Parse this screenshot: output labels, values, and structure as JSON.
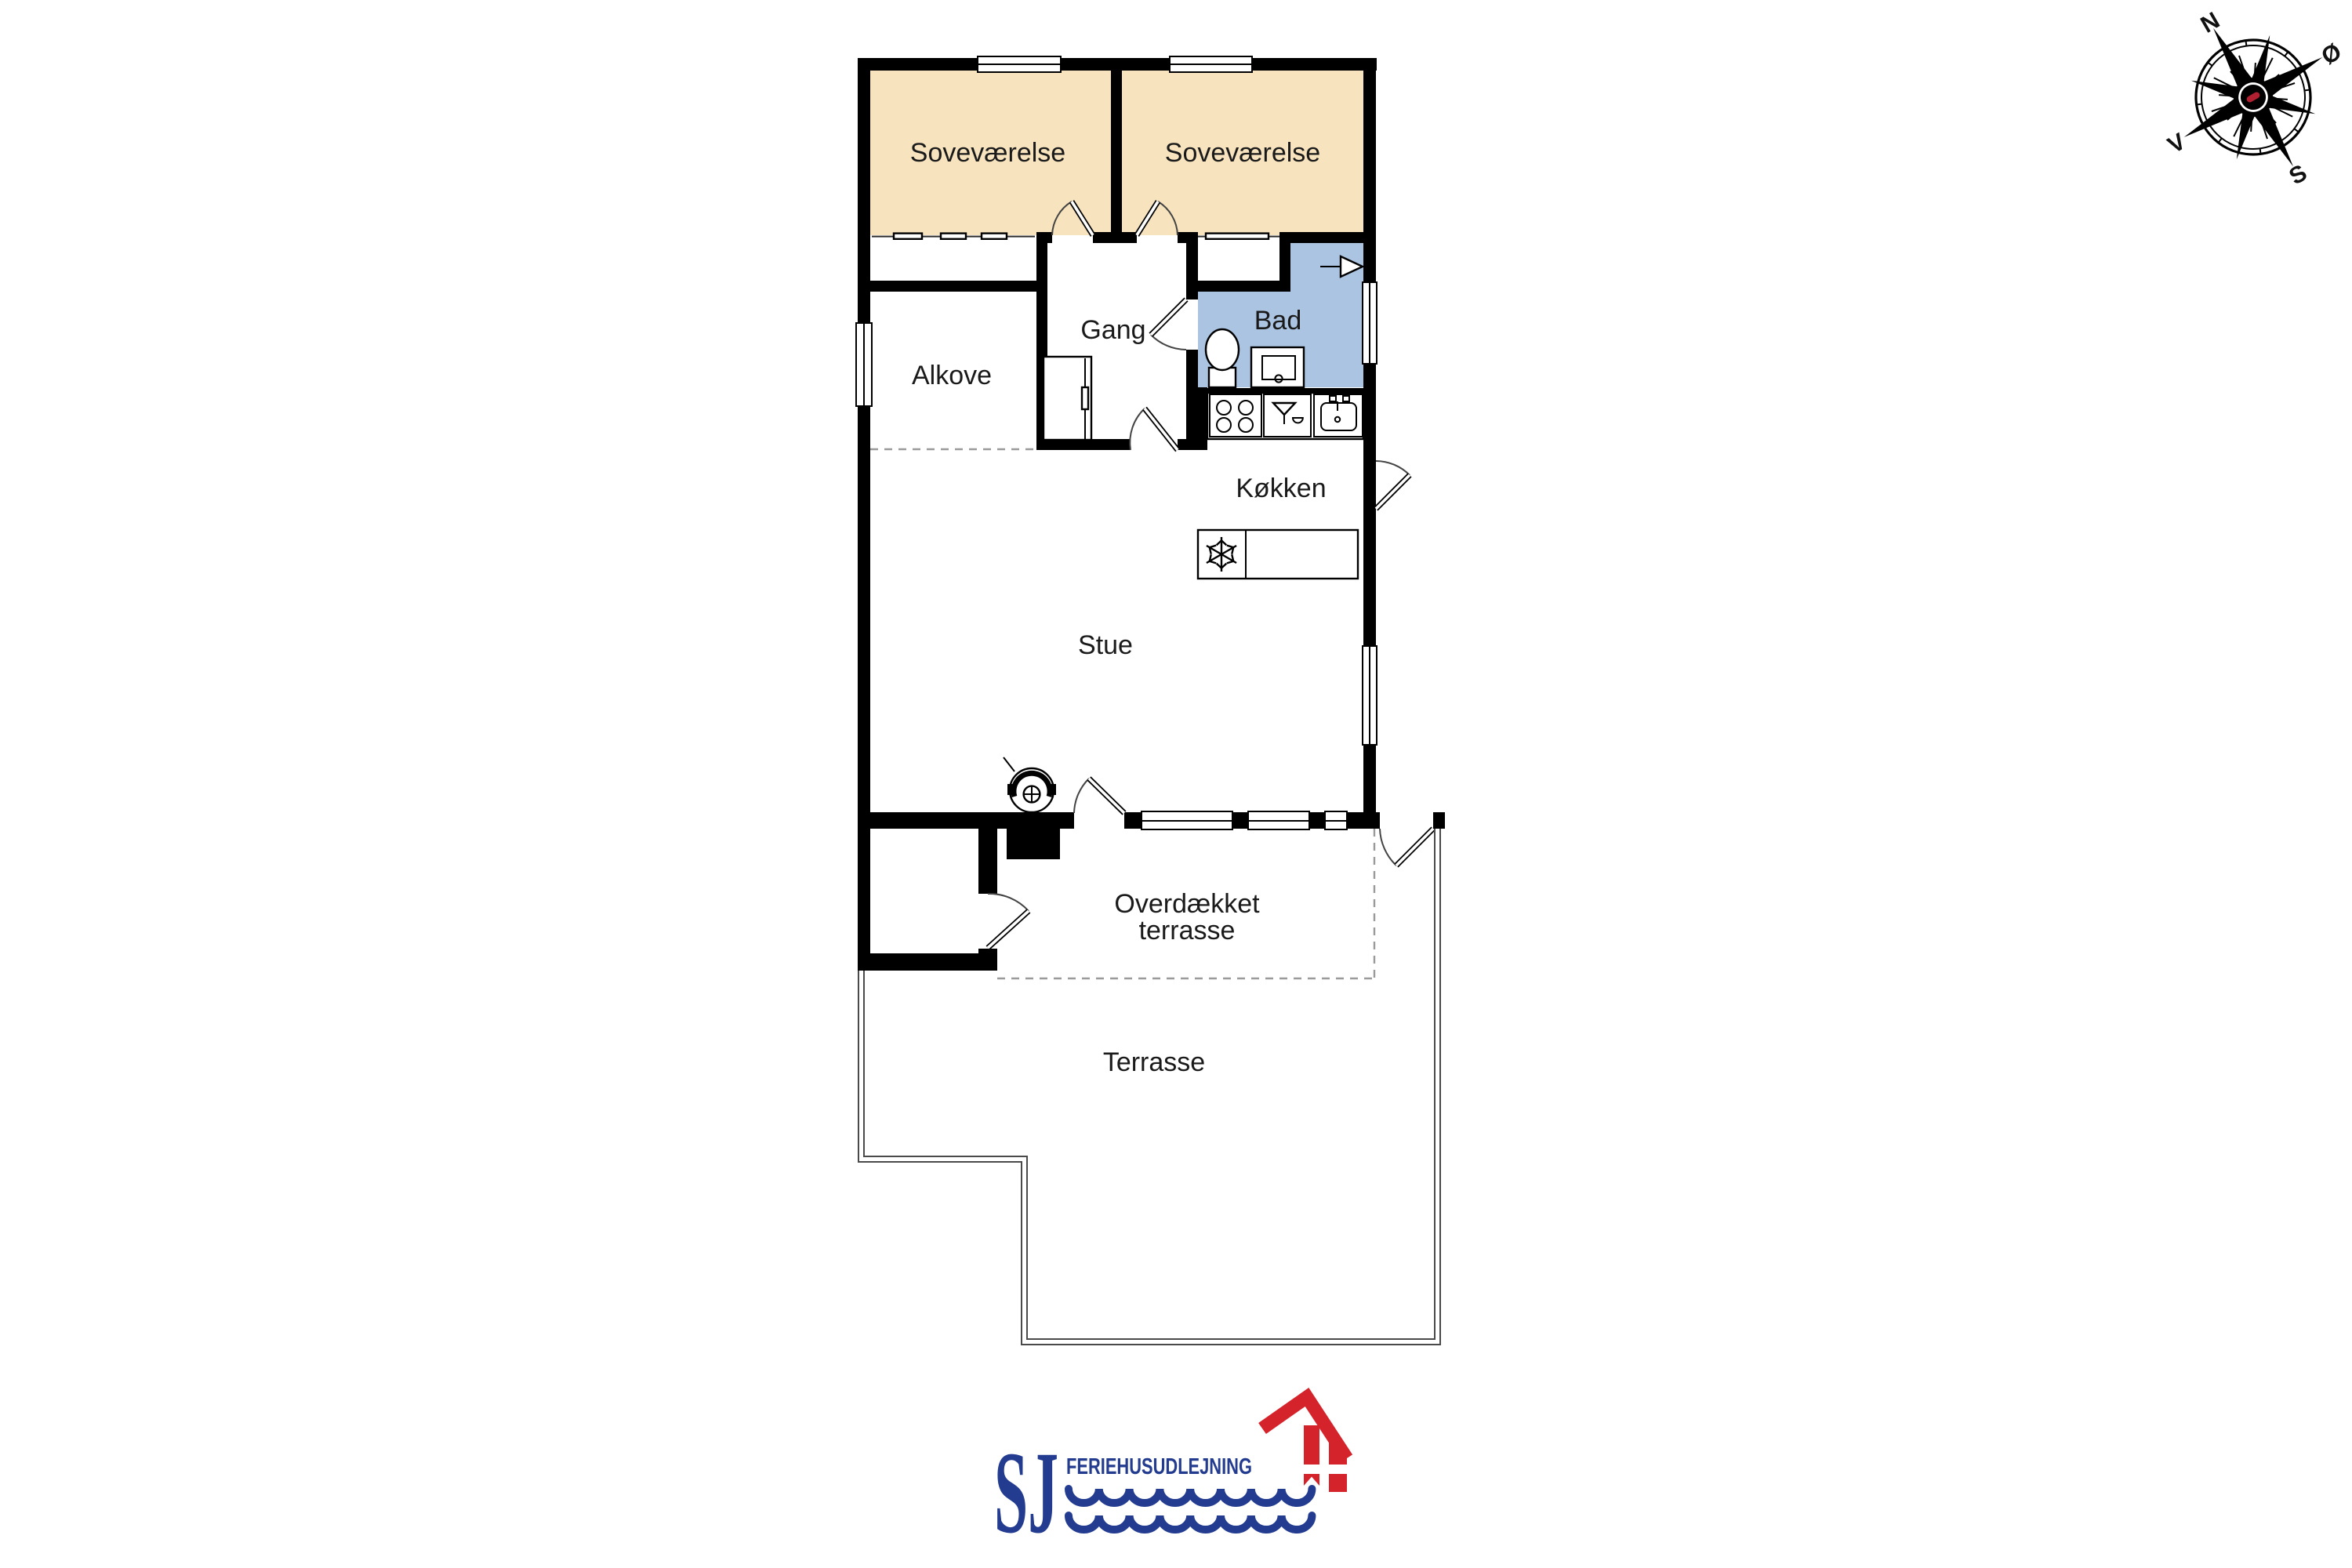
{
  "plan": {
    "rooms": {
      "bedroom_1": {
        "label": "Soveværelse"
      },
      "bedroom_2": {
        "label": "Soveværelse"
      },
      "hallway": {
        "label": "Gang"
      },
      "bathroom": {
        "label": "Bad"
      },
      "alcove": {
        "label": "Alkove"
      },
      "kitchen": {
        "label": "Køkken"
      },
      "living_room": {
        "label": "Stue"
      },
      "covered_terrace": {
        "label_line_1": "Overdækket",
        "label_line_2": "terrasse"
      },
      "terrace": {
        "label": "Terrasse"
      }
    },
    "colors": {
      "bedroom_fill": "#f7e3bd",
      "bathroom_fill": "#aac4e2",
      "wall": "#000000",
      "dashed_boundary": "#9a9a9a"
    }
  },
  "compass": {
    "north": "N",
    "east": "Ø",
    "south": "S",
    "west": "V"
  },
  "logo": {
    "initials": "SJ",
    "company": "FERIEHUSUDLEJNING",
    "navy": "#243c8f",
    "red": "#d5232b"
  },
  "icons": {
    "compass_rose": "16-point compass star",
    "wood_stove": "round stove with flue",
    "freezer_snowflake": "snowflake",
    "stove_burners": "four burner circles",
    "bar_sink": "basin glyph",
    "kitchen_sink": "basin with faucet",
    "toilet": "toilet oval with cistern",
    "shower": "square shower with drain",
    "vent_arrow": "ventilation arrow",
    "logo_house": "red house with white cross window",
    "logo_waves": "two scalloped wave lines"
  }
}
